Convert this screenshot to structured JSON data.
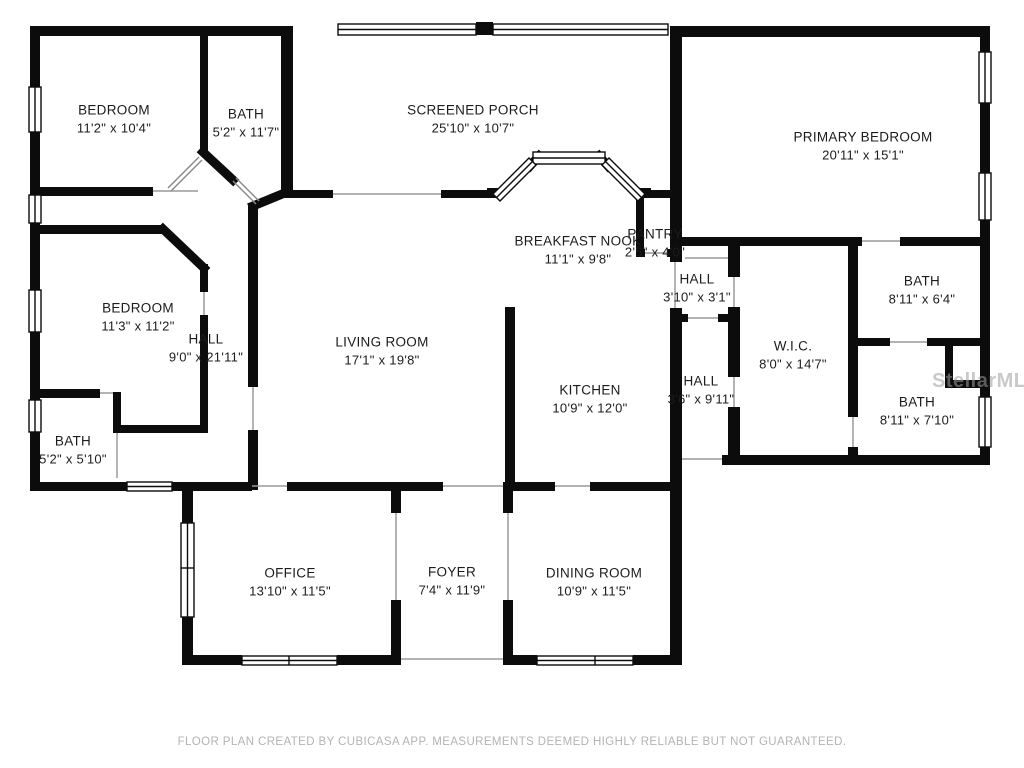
{
  "floor_plan": {
    "footer": "FLOOR PLAN CREATED BY CUBICASA APP. MEASUREMENTS DEEMED HIGHLY RELIABLE BUT NOT GUARANTEED.",
    "watermark": "StellarMLS",
    "wall_color": "#0c0c0c",
    "label_color": "#1c1c1c",
    "rooms": [
      {
        "id": "bedroom-top-left",
        "name": "BEDROOM",
        "dims": "11'2\" x 10'4\"",
        "x": 114,
        "y": 119
      },
      {
        "id": "bath-top-left",
        "name": "BATH",
        "dims": "5'2\" x 11'7\"",
        "x": 246,
        "y": 123
      },
      {
        "id": "screened-porch",
        "name": "SCREENED PORCH",
        "dims": "25'10\" x 10'7\"",
        "x": 473,
        "y": 119
      },
      {
        "id": "primary-bedroom",
        "name": "PRIMARY BEDROOM",
        "dims": "20'11\" x 15'1\"",
        "x": 863,
        "y": 146
      },
      {
        "id": "breakfast-nook",
        "name": "BREAKFAST NOOK",
        "dims": "11'1\" x 9'8\"",
        "x": 578,
        "y": 250
      },
      {
        "id": "pantry",
        "name": "PANTRY",
        "dims": "2'5\" x 4'0\"",
        "x": 655,
        "y": 243
      },
      {
        "id": "hall-small",
        "name": "HALL",
        "dims": "3'10\" x 3'1\"",
        "x": 697,
        "y": 288
      },
      {
        "id": "bath-east-1",
        "name": "BATH",
        "dims": "8'11\" x 6'4\"",
        "x": 922,
        "y": 290
      },
      {
        "id": "bedroom-mid-left",
        "name": "BEDROOM",
        "dims": "11'3\" x 11'2\"",
        "x": 138,
        "y": 317
      },
      {
        "id": "hall-main",
        "name": "HALL",
        "dims": "9'0\" x 21'11\"",
        "x": 206,
        "y": 348
      },
      {
        "id": "living-room",
        "name": "LIVING ROOM",
        "dims": "17'1\" x 19'8\"",
        "x": 382,
        "y": 351
      },
      {
        "id": "kitchen",
        "name": "KITCHEN",
        "dims": "10'9\" x 12'0\"",
        "x": 590,
        "y": 399
      },
      {
        "id": "hall-narrow",
        "name": "HALL",
        "dims": "3'6\" x 9'11\"",
        "x": 701,
        "y": 390
      },
      {
        "id": "wic",
        "name": "W.I.C.",
        "dims": "8'0\" x 14'7\"",
        "x": 793,
        "y": 355
      },
      {
        "id": "bath-east-2",
        "name": "BATH",
        "dims": "8'11\" x 7'10\"",
        "x": 917,
        "y": 411
      },
      {
        "id": "bath-bottom-left",
        "name": "BATH",
        "dims": "5'2\" x 5'10\"",
        "x": 73,
        "y": 450
      },
      {
        "id": "office",
        "name": "OFFICE",
        "dims": "13'10\" x 11'5\"",
        "x": 290,
        "y": 582
      },
      {
        "id": "foyer",
        "name": "FOYER",
        "dims": "7'4\" x 11'9\"",
        "x": 452,
        "y": 581
      },
      {
        "id": "dining-room",
        "name": "DINING ROOM",
        "dims": "10'9\" x 11'5\"",
        "x": 594,
        "y": 582
      }
    ]
  }
}
